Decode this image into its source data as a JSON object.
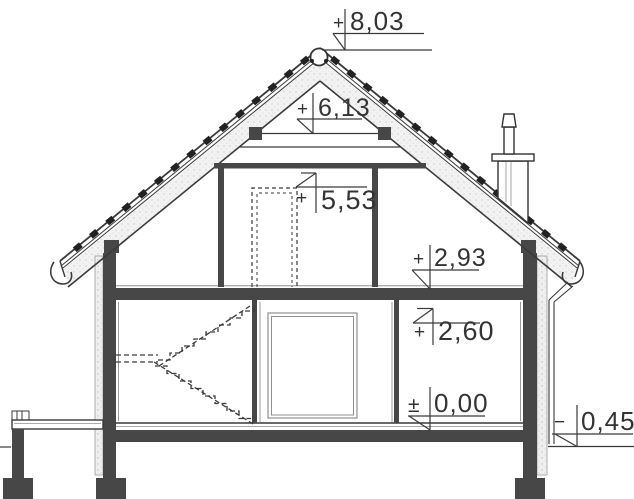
{
  "drawing": {
    "type": "architectural-cross-section",
    "title": "House cross-section with elevation levels",
    "colors": {
      "line": "#3a3a3a",
      "wall_fill": "#474747",
      "insulation_fill": "#efefef",
      "thin_line": "#8f8f8f",
      "paper": "#ffffff"
    },
    "levels": {
      "ridge": {
        "sign": "+",
        "value": "8,03"
      },
      "collar_beam": {
        "sign": "+",
        "value": "6,13"
      },
      "attic_ceiling": {
        "sign": "+",
        "value": "5,53"
      },
      "attic_floor": {
        "sign": "+",
        "value": "2,93"
      },
      "ground_ceiling": {
        "sign": "+",
        "value": "2,60"
      },
      "ground_floor": {
        "sign": "±",
        "value": "0,00"
      },
      "terrain": {
        "sign": "−",
        "value": "0,45"
      }
    }
  }
}
